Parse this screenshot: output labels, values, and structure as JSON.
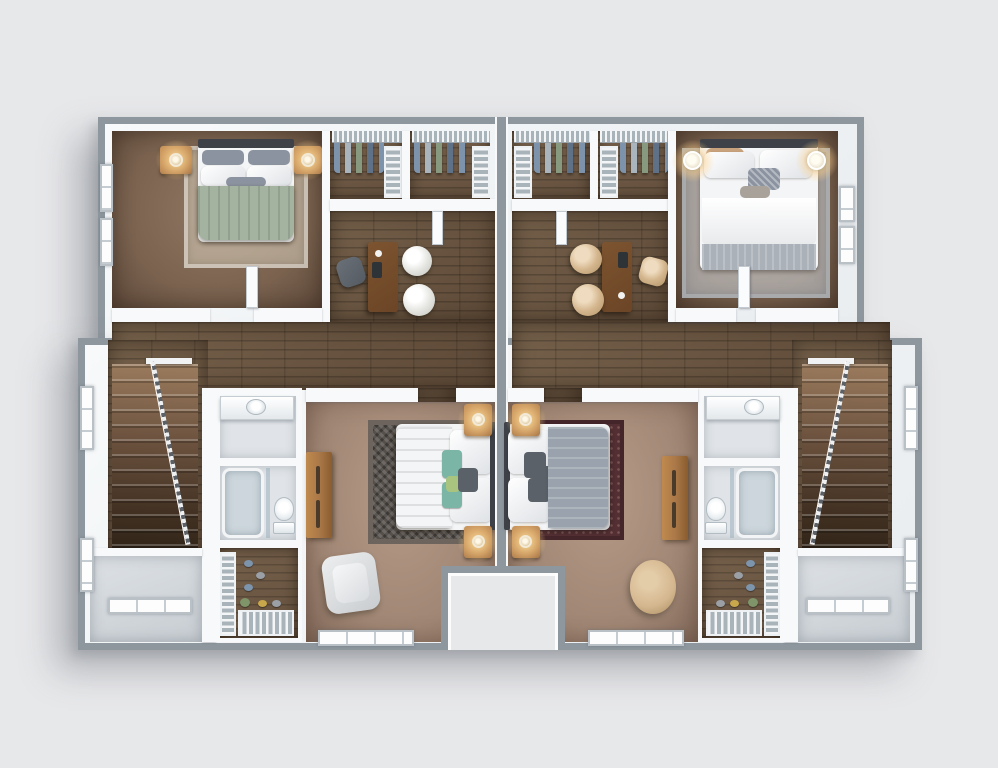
{
  "scene": {
    "type": "3d-rendered-floor-plan",
    "view": "top-down isometric",
    "description": "mirrored two-unit residential upper floor",
    "units_count": 2
  },
  "units": {
    "left_unit": {
      "rooms": [
        "bedroom",
        "closet-a",
        "closet-b",
        "office-loft",
        "hallway",
        "staircase",
        "bathroom",
        "walk-in-closet",
        "master-bedroom",
        "stair-landing"
      ],
      "furniture": [
        "double-bed-sage",
        "nightstands-with-lamps",
        "desk",
        "office-chair-gray",
        "guest-chairs-white",
        "vanity-sink",
        "bathtub-glass",
        "toilet",
        "master-bed-sage",
        "candle-lamps",
        "dresser",
        "armchair-gray",
        "shoe-racks",
        "hanging-clothes"
      ]
    },
    "right_unit": {
      "rooms": [
        "bedroom",
        "closet-a",
        "closet-b",
        "office-loft",
        "hallway",
        "staircase",
        "bathroom",
        "walk-in-closet",
        "master-bedroom",
        "stair-landing"
      ],
      "furniture": [
        "double-bed-white-gray",
        "wall-lamps",
        "desk",
        "office-chair-beige",
        "guest-chairs-beige",
        "vanity-sink",
        "bathtub-glass",
        "toilet",
        "master-bed-gray",
        "candle-lamps",
        "dresser",
        "armchair-beige",
        "shoe-racks",
        "hanging-clothes"
      ]
    }
  },
  "colors": {
    "bg": "#e7e8ea",
    "shadow": "rgba(95,100,110,0.40)",
    "outer": "#8e979e",
    "wall": "#e9edf0",
    "wallHi": "#f7f9fa",
    "carpetTL1": "#7a624f",
    "carpetTL2": "#907763",
    "carpetM1": "#a08674",
    "carpetM2": "#b59a87",
    "wood1": "#5d4937",
    "wood2": "#74604a",
    "woodC": "#64503d",
    "bathFloor": "#e0e4e8",
    "landing": "#c7cdd2",
    "stairA": "#9c7c5e",
    "stairB": "#2c2115",
    "railA": "#eef0f2",
    "railB": "#5c6167",
    "rugTL": "rgba(216,207,190,0.55)",
    "rugTR": "rgba(198,203,208,0.60)",
    "rugLa": "#56504b",
    "rugLb": "#6c645d",
    "rugRa": "#532f33",
    "rugRdot": "rgba(215,165,155,0.30)",
    "sage": "#a3b39f",
    "sageFold": "#8ba089",
    "duvetGray": "#9aa3ad",
    "duvetFold": "#aab1b9",
    "whiteF": "#f4f5f6",
    "pillowSlate": "#8b93a0",
    "pillowTeal": "#7ab5a6",
    "pillowLime": "#a8c47e",
    "pillowDark": "#5a6168",
    "pillowTan": "#c8a27c",
    "headboard": "#3e4248",
    "stand": "#a97747",
    "standHi": "#c49058",
    "deskW": "#6b4526",
    "chairW": "#e4e4e0",
    "chairB": "#d4b68e",
    "chairG": "#555b62",
    "porcelain": "#f2f4f6",
    "tubIn": "#ccd6dc",
    "glass": "rgba(150,172,186,0.50)",
    "doorW": "#fafbfc",
    "glowC": "rgba(255,226,160,0.95)",
    "rodA": "#f3f5f7",
    "rodB": "#a9b3ba",
    "clothA": "#7d93ab",
    "clothB": "#aab4bd",
    "clothC": "#87997f",
    "clothD": "#5e7186",
    "shoeGold": "#c9a84c",
    "shoeBlue": "#7d94ad",
    "shoeGray": "#9aa0a6",
    "plant": "#7f9468"
  }
}
